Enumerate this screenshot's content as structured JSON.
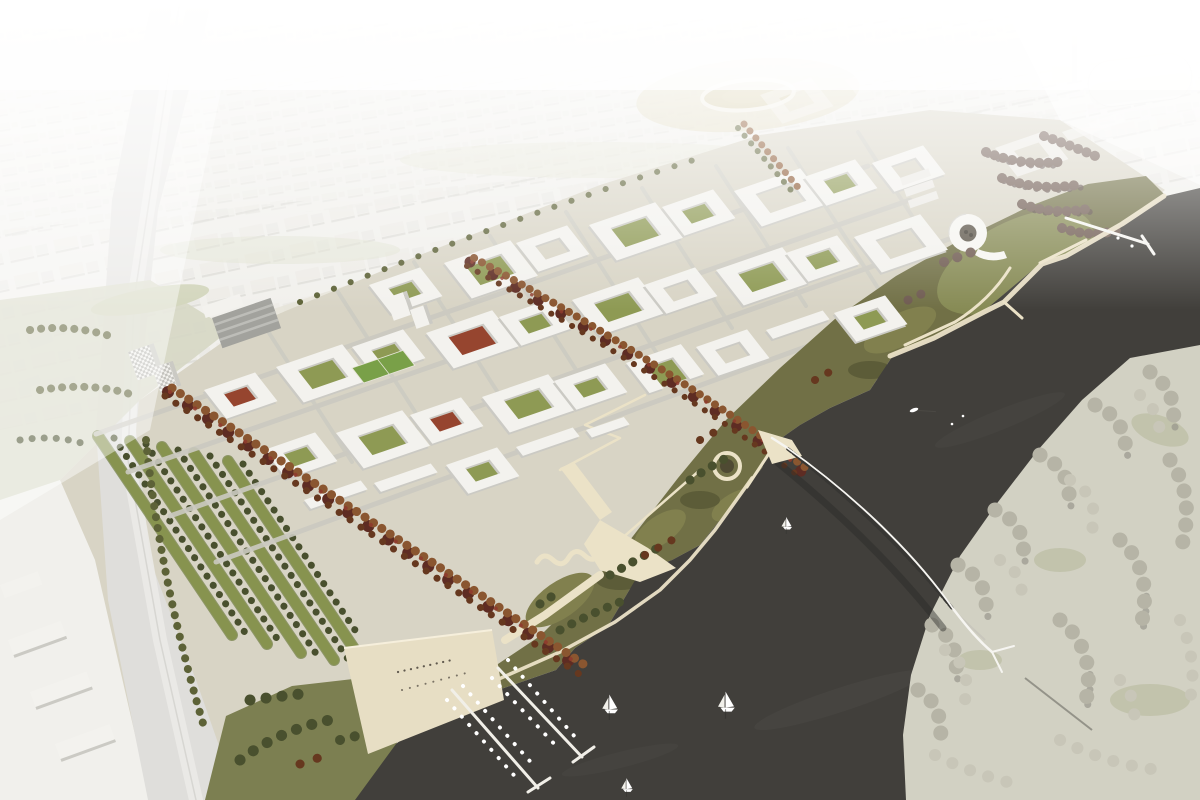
{
  "scene": {
    "title": "Aerial architectural rendering of a riverfront masterplan district with marina, park and pedestrian bridge",
    "media_type": "architectural visualization (bird's-eye render)",
    "view": "oblique aerial view, hazy white context city fading to the horizon"
  },
  "palette": {
    "base": "#f1f0ec",
    "city_block": "#eceae5",
    "city_far": "#e9e8e3",
    "city_shadow": "#d9d8d2",
    "khaki": "#ded7ba",
    "corridor": "#dfdedb",
    "corridor_light": "#ebeae7",
    "ground": "#d8d4c5",
    "street": "#cbcac1",
    "building_white": "#f3f2ee",
    "building_side": "#cbcac4",
    "building_dark": "#a2a29d",
    "glass_stripe": "#c2c2bd",
    "green_roof": "#87934f",
    "green_roof_dark": "#6f7d42",
    "courtyard_green": "#8e9a54",
    "courtyard_red": "#96452f",
    "red_accent": "#8e3b2d",
    "pitch_green": "#79a048",
    "park_olive": "#717046",
    "park_light": "#81804e",
    "park_dark": "#5c5c38",
    "lawn": "#8b8f58",
    "meadow": "#7c7f51",
    "path_cream": "#ebe2c7",
    "plaza": "#e7dec4",
    "tree_autumn": "#8a5630",
    "tree_autumn_dark": "#66381f",
    "tree_maroon": "#5e2c23",
    "tree_olive": "#5d6237",
    "tree_green_dark": "#49502e",
    "tree_bare": "#6f5b51",
    "tree_bare_dark": "#564540",
    "bank": "#d2d1c3",
    "bank_green": "#c2c3ac",
    "tree_pale": "#b6b4a6",
    "tree_pale_light": "#c8c6b8",
    "tree_pale_dark": "#95938a",
    "water": "#413f3b",
    "water_light": "#4c4a45",
    "bridge_white": "#f6f5f1",
    "deck_dark": "#373633",
    "boat_white": "#ffffff",
    "spiral_core": "#5d564a",
    "people": "#5f584d"
  },
  "inventory": {
    "background_city": "hazy white existing city grid fading into fog at the horizon",
    "stadium_oval": "khaki field with white oval running track in the context city",
    "arena_building": "large rounded white arena at the upper right",
    "highrise_tower": "tall pale tower on the skyline",
    "rail_corridor": "light grey rail / road corridor along the west edge",
    "warehouses": "white industrial sheds west of the corridor",
    "allotment_rows": "long green-roofed rows with tree lines on the south-west edge",
    "urban_blocks": "white perimeter blocks with green, red and paved courtyards",
    "sports_pitch": "green playing field inside the development",
    "office_slab": "dark glazed office slab at the west entrance",
    "checkered_towers": "pair of chequer-patterned towers",
    "spiral_building": "white spiral-ramp landmark building near the north shore",
    "autumn_boulevards": "diagonal avenues of orange-brown autumn trees with red accents",
    "winter_grove": "cluster of bare purple-brown trees by the spiral building",
    "riverfront_park": "olive-green park with winding cream paths, wave path and circular tree planter",
    "quay_promenade": "white zig-zag boardwalk along the north-east quay",
    "north_pier": "long white pier reaching into the water at the north-east",
    "marina_plaza": "beige quay plaza with tiny figures and two floating piers",
    "moored_boats": "small white dinghies moored along the marina piers",
    "pedestrian_bridge": "white lens-shaped footbridge with dark deck crossing the river",
    "river": "dark charcoal river water",
    "far_bank": "pale wooded opposite river bank with a diagonal path",
    "sailboats": "white sailboats under sail on the river"
  },
  "counts": {
    "sailboats": 4,
    "motor_dinghies": 1,
    "marina_piers": 2,
    "allotment_rows": 5,
    "courtyard_blocks": 27,
    "autumn_boulevards": 2
  }
}
